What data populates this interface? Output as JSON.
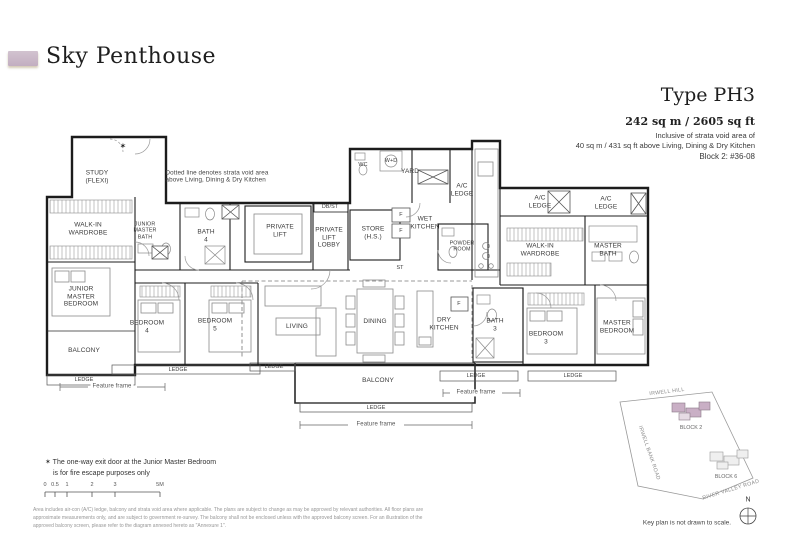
{
  "header": {
    "title": "Sky Penthouse",
    "type_label": "Type PH3",
    "area": "242 sq m / 2605 sq ft",
    "inclusive_note_line1": "Inclusive of strata void area of",
    "inclusive_note_line2": "40 sq m / 431 sq ft above Living, Dining & Dry Kitchen",
    "unit": "Block 2: #36-08"
  },
  "plan": {
    "labels": [
      {
        "name": "study",
        "text": "STUDY\n(FLEXI)",
        "x": 97,
        "y": 177
      },
      {
        "name": "star-mark",
        "text": "✶",
        "x": 123,
        "y": 146,
        "size": "star"
      },
      {
        "name": "void-note",
        "text": "Dotted line denotes strata void area\nabove Living, Dining & Dry Kitchen",
        "x": 217,
        "y": 177,
        "size": "note"
      },
      {
        "name": "walk-in-wardrobe-left",
        "text": "WALK-IN\nWARDROBE",
        "x": 88,
        "y": 229
      },
      {
        "name": "junior-master-bath",
        "text": "JUNIOR\nMASTER\nBATH",
        "x": 145,
        "y": 231,
        "size": "xs"
      },
      {
        "name": "bath-4",
        "text": "BATH\n4",
        "x": 206,
        "y": 236
      },
      {
        "name": "private-lift",
        "text": "PRIVATE\nLIFT",
        "x": 280,
        "y": 231
      },
      {
        "name": "db-st",
        "text": "DB/ST",
        "x": 330,
        "y": 207,
        "size": "xs"
      },
      {
        "name": "private-lift-lobby",
        "text": "PRIVATE\nLIFT\nLOBBY",
        "x": 329,
        "y": 238
      },
      {
        "name": "store",
        "text": "STORE\n(H.S.)",
        "x": 373,
        "y": 233
      },
      {
        "name": "wc",
        "text": "WC",
        "x": 363,
        "y": 165,
        "size": "xs"
      },
      {
        "name": "w-d",
        "text": "W+D",
        "x": 391,
        "y": 161,
        "size": "xs"
      },
      {
        "name": "yard",
        "text": "YARD",
        "x": 410,
        "y": 172
      },
      {
        "name": "ac-ledge-yard",
        "text": "A/C\nLEDGE",
        "x": 462,
        "y": 190
      },
      {
        "name": "wet-kitchen",
        "text": "WET\nKITCHEN",
        "x": 425,
        "y": 223
      },
      {
        "name": "powder-room",
        "text": "POWDER\nROOM",
        "x": 462,
        "y": 247,
        "size": "xs"
      },
      {
        "name": "st",
        "text": "ST",
        "x": 400,
        "y": 268,
        "size": "xs"
      },
      {
        "name": "ac-ledge-mid",
        "text": "A/C\nLEDGE",
        "x": 540,
        "y": 202
      },
      {
        "name": "ac-ledge-right",
        "text": "A/C\nLEDGE",
        "x": 606,
        "y": 203
      },
      {
        "name": "walk-in-wardrobe-right",
        "text": "WALK-IN\nWARDROBE",
        "x": 540,
        "y": 250
      },
      {
        "name": "master-bath",
        "text": "MASTER\nBATH",
        "x": 608,
        "y": 250
      },
      {
        "name": "junior-master-bedroom",
        "text": "JUNIOR\nMASTER\nBEDROOM",
        "x": 81,
        "y": 297
      },
      {
        "name": "balcony-left",
        "text": "BALCONY",
        "x": 84,
        "y": 351
      },
      {
        "name": "bedroom-4",
        "text": "BEDROOM\n4",
        "x": 147,
        "y": 327
      },
      {
        "name": "bedroom-5",
        "text": "BEDROOM\n5",
        "x": 215,
        "y": 325
      },
      {
        "name": "living",
        "text": "LIVING",
        "x": 297,
        "y": 327
      },
      {
        "name": "dining",
        "text": "DINING",
        "x": 375,
        "y": 322
      },
      {
        "name": "dry-kitchen",
        "text": "DRY\nKITCHEN",
        "x": 444,
        "y": 324
      },
      {
        "name": "bath-3",
        "text": "BATH\n3",
        "x": 495,
        "y": 325
      },
      {
        "name": "bedroom-3",
        "text": "BEDROOM\n3",
        "x": 546,
        "y": 338
      },
      {
        "name": "master-bedroom",
        "text": "MASTER\nBEDROOM",
        "x": 617,
        "y": 327
      },
      {
        "name": "balcony-center",
        "text": "BALCONY",
        "x": 378,
        "y": 381
      },
      {
        "name": "fridge-1",
        "text": "F",
        "x": 401,
        "y": 215,
        "size": "xs"
      },
      {
        "name": "fridge-2",
        "text": "F",
        "x": 401,
        "y": 231,
        "size": "xs"
      },
      {
        "name": "fridge-3",
        "text": "F",
        "x": 459,
        "y": 304,
        "size": "xs"
      },
      {
        "name": "ledge-left-balcony",
        "text": "LEDGE",
        "x": 84,
        "y": 380,
        "size": "xs"
      },
      {
        "name": "ledge-bedrooms",
        "text": "LEDGE",
        "x": 178,
        "y": 370,
        "size": "xs"
      },
      {
        "name": "ledge-living",
        "text": "LEDGE",
        "x": 274,
        "y": 367,
        "size": "xs"
      },
      {
        "name": "ledge-balcony",
        "text": "LEDGE",
        "x": 376,
        "y": 408,
        "size": "xs"
      },
      {
        "name": "ledge-bath3",
        "text": "LEDGE",
        "x": 476,
        "y": 376,
        "size": "xs"
      },
      {
        "name": "ledge-master",
        "text": "LEDGE",
        "x": 573,
        "y": 376,
        "size": "xs"
      },
      {
        "name": "feature-frame-left",
        "text": "Feature frame",
        "x": 112,
        "y": 387,
        "size": "ff"
      },
      {
        "name": "feature-frame-center",
        "text": "Feature frame",
        "x": 376,
        "y": 425,
        "size": "ff"
      },
      {
        "name": "feature-frame-right",
        "text": "Feature frame",
        "x": 476,
        "y": 393,
        "size": "ff"
      }
    ]
  },
  "notes": {
    "star_note_line1": "✶ The one-way exit door at the Junior Master Bedroom",
    "star_note_line2": "is for fire escape purposes only",
    "disclaimer": "Area includes air-con (A/C) ledge, balcony and strata void area where applicable. The plans are subject to change as may be approved by relevant authorities. All floor plans are approximate measurements only, and are subject to government re-survey. The balcony shall not be enclosed unless with the approved balcony screen. For an illustration of the approved balcony screen, please refer to the diagram annexed hereto as \"Annexure 1\"."
  },
  "scale_bar": {
    "ticks": [
      "0",
      "0.5",
      "1",
      "2",
      "3",
      "5M"
    ]
  },
  "key_plan": {
    "roads": [
      "IRWELL HILL",
      "IRWELL BANK ROAD",
      "RIVER VALLEY ROAD"
    ],
    "blocks": [
      "BLOCK 2",
      "BLOCK 6"
    ],
    "note": "Key plan is not drawn to scale.",
    "compass_label": "N"
  },
  "colors": {
    "accent": "#c7b4c3",
    "block2_highlight": "#c9afc5"
  }
}
